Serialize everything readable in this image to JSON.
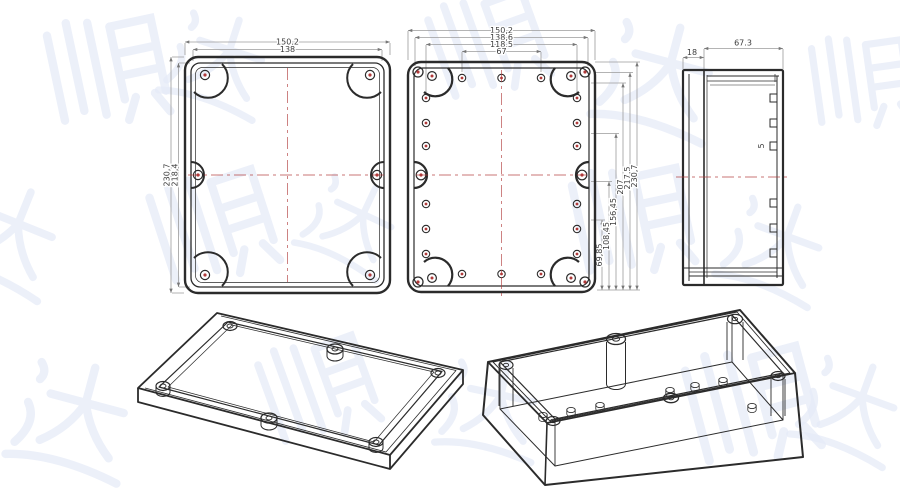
{
  "page": {
    "background": "#ffffff",
    "line_color": "#2b2b2b",
    "accent_red": "#b03a3a",
    "dim_line_color": "#9b9b9b"
  },
  "watermark": {
    "characters": [
      "顺",
      "达"
    ],
    "color": "#e6ebf8"
  },
  "lid_top_view": {
    "dim_width_outer": "150,2",
    "dim_width_inner": "138",
    "dim_height_outer": "230,7",
    "dim_height_inner": "218,4"
  },
  "base_top_view": {
    "dims_top": [
      "150,2",
      "138,6",
      "118,5",
      "67"
    ],
    "dims_right": [
      "69,85",
      "108,45",
      "156,45",
      "207",
      "217,5",
      "230,7"
    ]
  },
  "side_view": {
    "dim_lid_thickness": "18",
    "dim_body_depth": "67.3",
    "dim_boss": "5"
  }
}
